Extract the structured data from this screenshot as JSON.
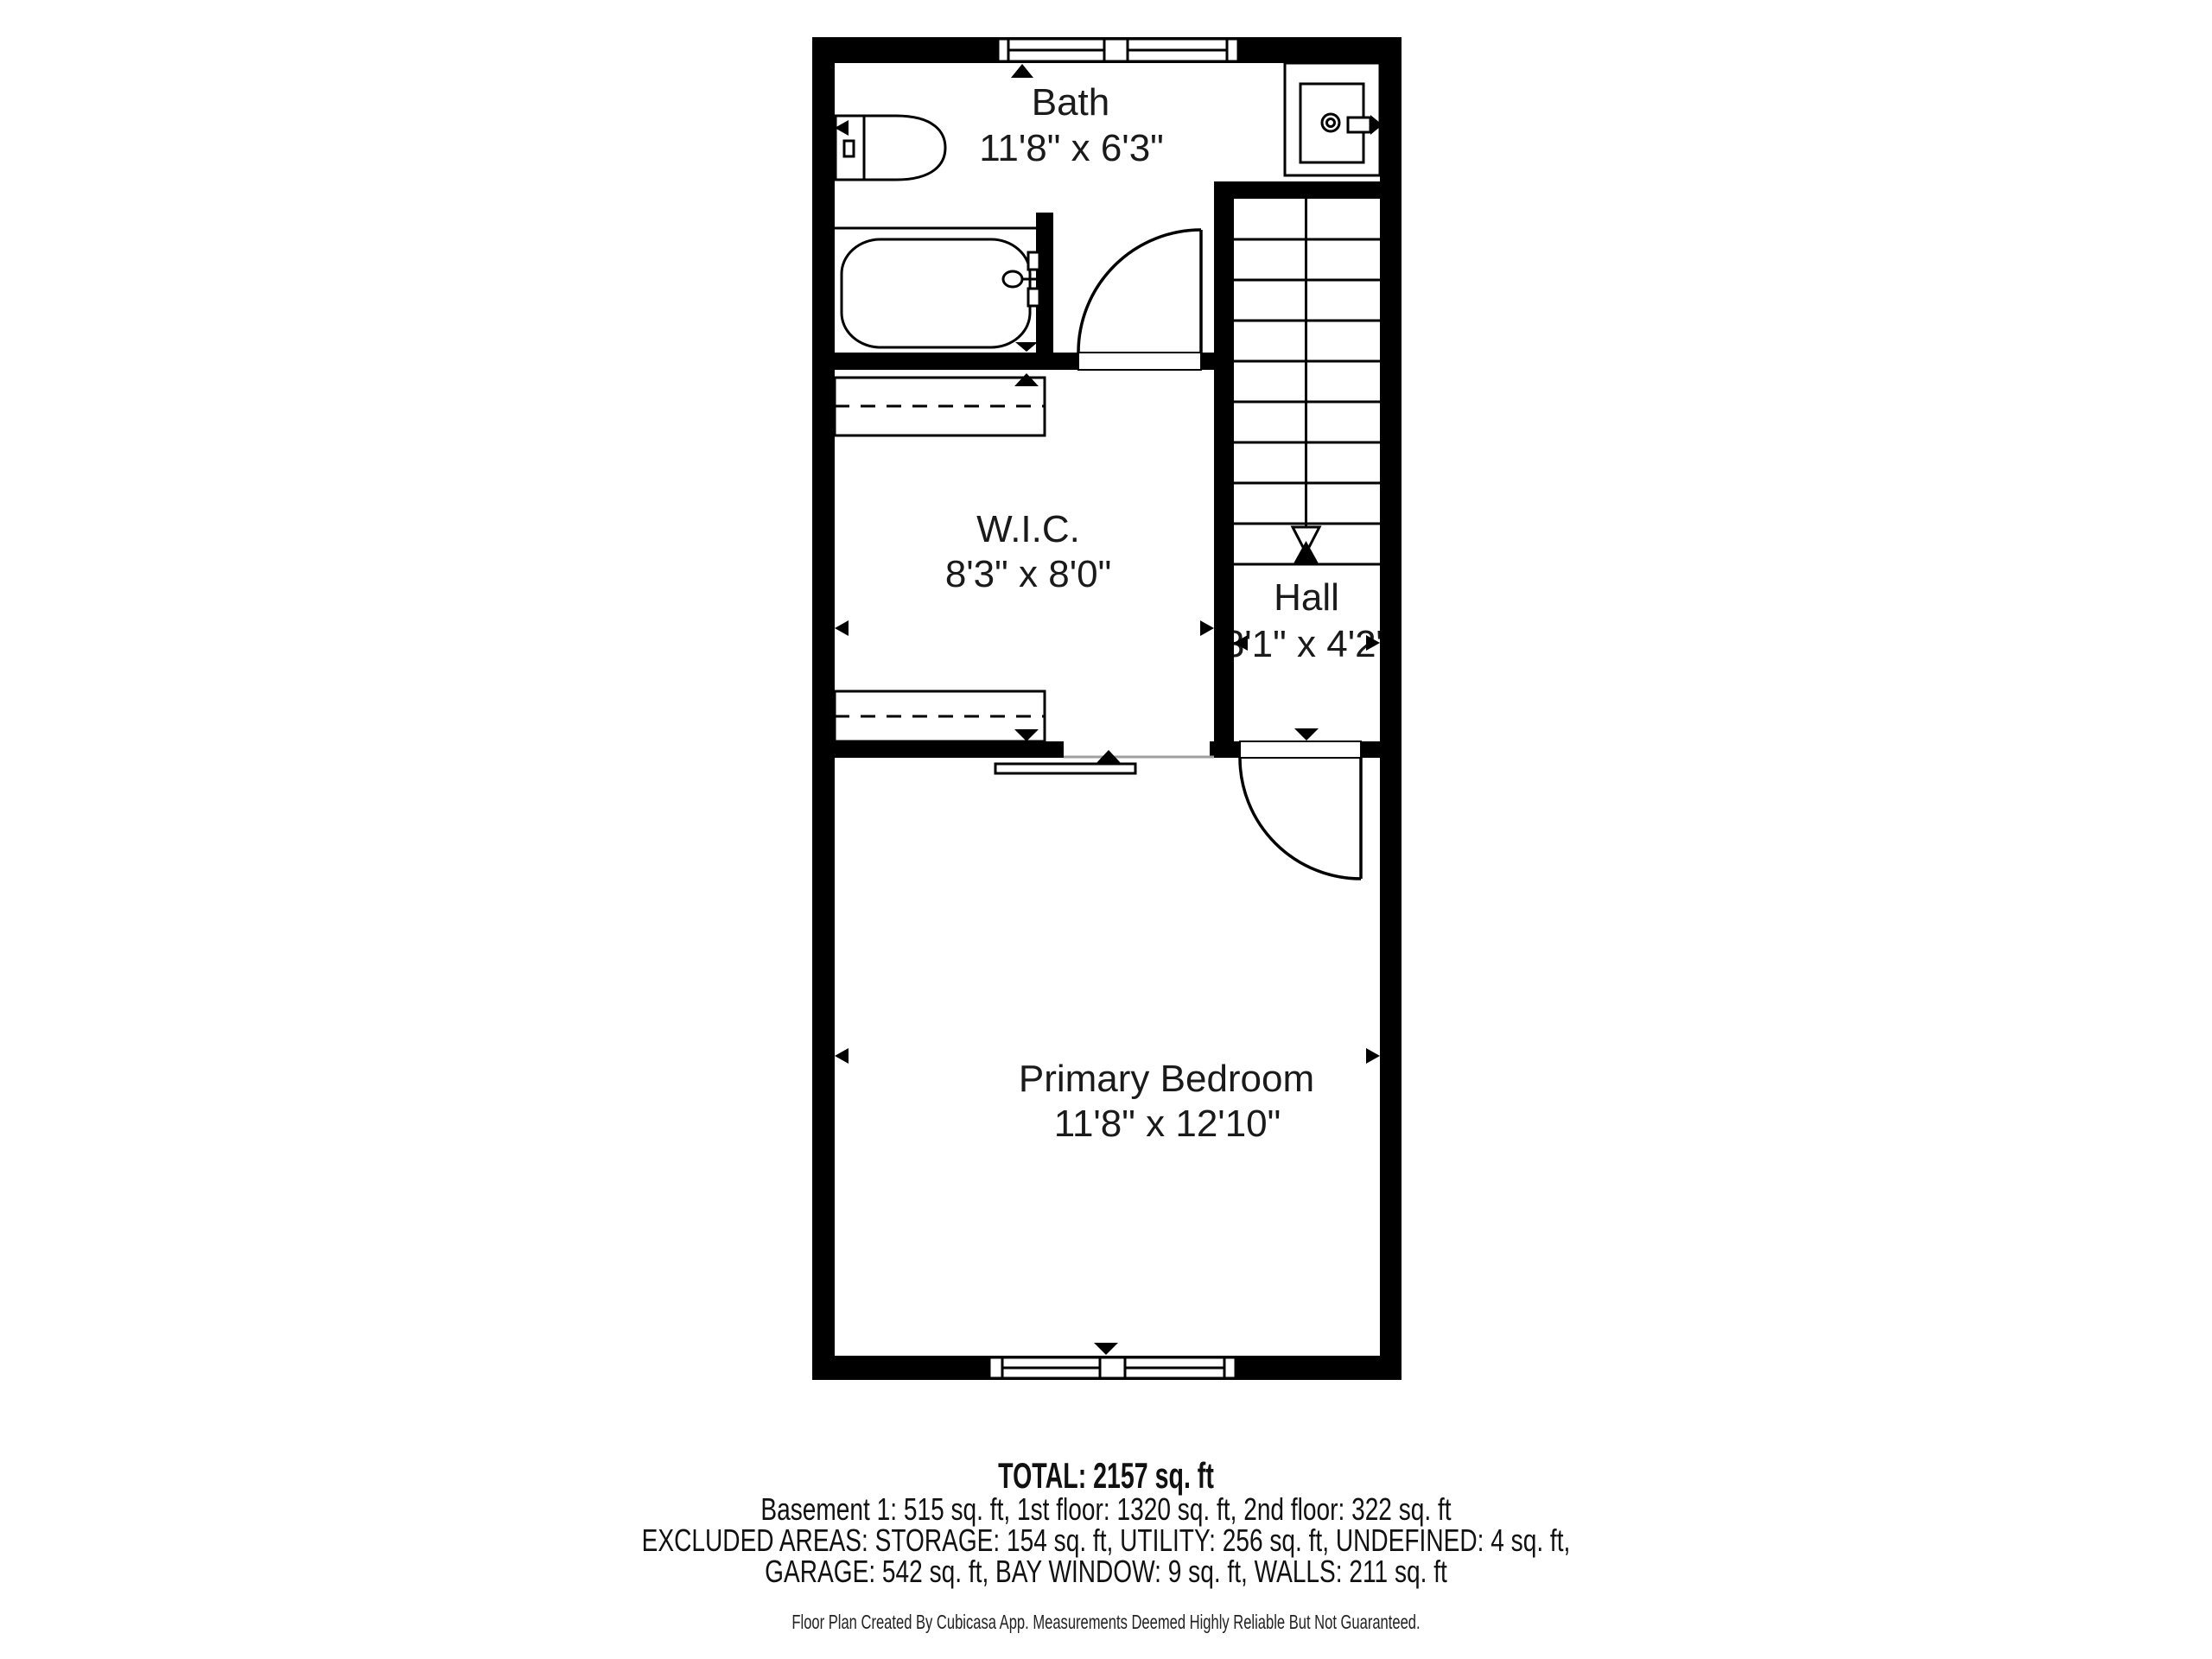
{
  "floor_plan": {
    "rooms": [
      {
        "name": "Bath",
        "dimensions": "11'8\" x 6'3\""
      },
      {
        "name": "W.I.C.",
        "dimensions": "8'3\" x 8'0\""
      },
      {
        "name": "Hall",
        "dimensions": "3'1\" x 4'2\""
      },
      {
        "name": "Primary Bedroom",
        "dimensions": "11'8\" x 12'10\""
      }
    ],
    "fixtures": [
      "toilet",
      "bathtub",
      "sink",
      "stairs",
      "closet-shelves",
      "sliding-door",
      "hinged-doors",
      "windows"
    ],
    "summary": {
      "total": "TOTAL: 2157 sq. ft",
      "floors": "Basement 1: 515 sq. ft, 1st floor: 1320 sq. ft, 2nd floor: 322 sq. ft",
      "excluded_line1": "EXCLUDED AREAS: STORAGE: 154 sq. ft, UTILITY: 256 sq. ft, UNDEFINED: 4 sq. ft,",
      "excluded_line2": "GARAGE: 542 sq. ft, BAY WINDOW: 9 sq. ft, WALLS: 211 sq. ft"
    },
    "footer": "Floor Plan Created By Cubicasa App. Measurements Deemed Highly Reliable But Not Guaranteed.",
    "colors": {
      "walls": "#000000",
      "text": "#1a1a1a",
      "open_wall_line": "#a0a0a0",
      "background": "#ffffff"
    }
  }
}
